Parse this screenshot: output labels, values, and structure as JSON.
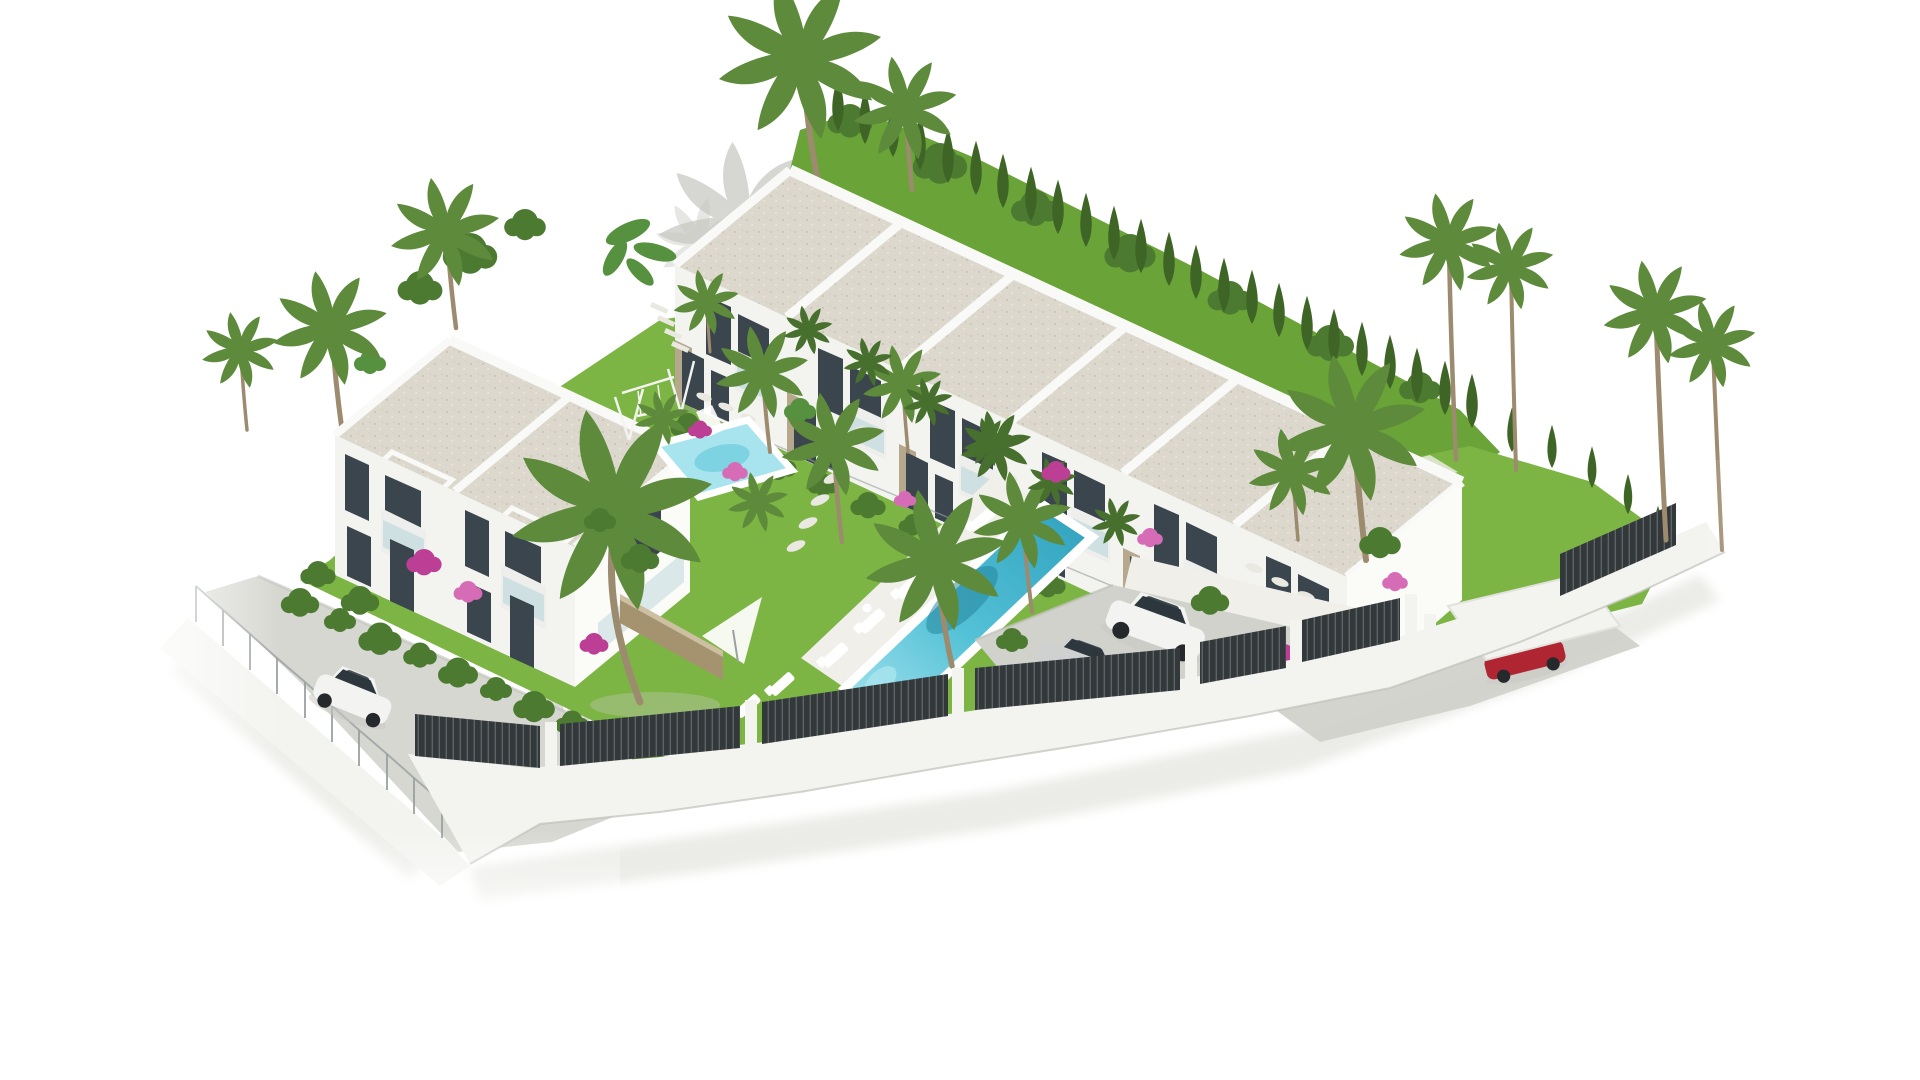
{
  "meta": {
    "title": "Aerial 3D render of a new residential development",
    "alt": "Aerial 3D architectural rendering on a plain white background: a row of six white two-storey townhouses with flat gravel roofs, a detached two-unit white villa, communal gardens with a long swimming pool and sun loungers, a small pool with a children's swing set, a grey parking area with a white SUV and a silver sedan, a red car at the entrance gate, a white hatchback on the access street, palm trees, a cypress hedge and a dark slatted perimeter fence on a white wall."
  },
  "colors": {
    "bg": "#ffffff",
    "wall": "#f3f3f0",
    "wall_sun": "#fbfbf8",
    "wall_shade": "#e4e5e0",
    "parapet": "#f9f9f7",
    "roof": "#d9d3c6",
    "window": "#3a454d",
    "glass": "#c8dde1",
    "balcony": "#eeefec",
    "stone_clad": "#b6a88c",
    "stone_wall": "#a5926f",
    "stone_wall_top": "#cdbfa1",
    "grass": "#7db544",
    "grass_back": "#6aa338",
    "hedge": "#4d7a31",
    "cypress": "#3e6526",
    "palm": "#5d8a3b",
    "palm_dark": "#476f2d",
    "banana": "#55913f",
    "trunk": "#9c8b6e",
    "pool": "#53c1d6",
    "pool_light": "#a8e4ee",
    "pool_deep": "#2f9fbd",
    "pool_shadow": "#1f7f97",
    "deck": "#f0efe9",
    "path_stone": "#e9e8e1",
    "road": "#d7d7d2",
    "road_edge": "#c0c0ba",
    "parking": "#d2d2cc",
    "fence": "#33383a",
    "fence_slat": "#5d6366",
    "mesh": "#9aa0a0",
    "car_white": "#f3f4f2",
    "car_silver": "#ced1cf",
    "car_red": "#b02532",
    "car_glass": "#2d373d",
    "wheel": "#26292b",
    "boug": "#bd3f95",
    "boug_light": "#d76cb6",
    "shadow": "#c9c9c4",
    "shadow_soft": "#e3e3de",
    "white": "#ffffff"
  },
  "scene": {
    "buildings": [
      {
        "id": "townhouse-row",
        "label": "Row of six two-storey townhouses with flat gravel roofs and stone-clad accents",
        "units": 6
      },
      {
        "id": "villa-duplex",
        "label": "Detached two-unit villa with flat gravel roofs, balconies and bougainvillea",
        "units": 2
      }
    ],
    "amenities": [
      {
        "id": "main-pool",
        "label": "Long communal swimming pool with white deck and sun loungers"
      },
      {
        "id": "kids-pool",
        "label": "Small pool beside a children's swing set"
      },
      {
        "id": "parking",
        "label": "Residents' parking terrace"
      },
      {
        "id": "paths",
        "label": "Stepping-stone garden paths"
      }
    ],
    "vehicles": [
      {
        "id": "suv-white",
        "label": "White SUV parked in parking area"
      },
      {
        "id": "sedan-silver",
        "label": "Silver sedan parked in parking area"
      },
      {
        "id": "hatchback-white",
        "label": "White hatchback on the access street"
      },
      {
        "id": "car-red",
        "label": "Red car under canopy at entrance gate"
      }
    ],
    "vegetation": [
      {
        "id": "palms",
        "label": "Palm trees throughout gardens and along boundaries"
      },
      {
        "id": "cypress-hedge",
        "label": "Cypress hedge along rear boundary"
      },
      {
        "id": "lawns",
        "label": "Bright communal lawns"
      },
      {
        "id": "bougainvillea",
        "label": "Pink bougainvillea shrubs"
      }
    ],
    "boundary": [
      {
        "id": "dark-fence",
        "label": "Dark slatted fence on white perimeter wall"
      },
      {
        "id": "chain-fence",
        "label": "Wire-mesh fence along the street"
      },
      {
        "id": "street",
        "label": "Curved access street"
      }
    ]
  }
}
